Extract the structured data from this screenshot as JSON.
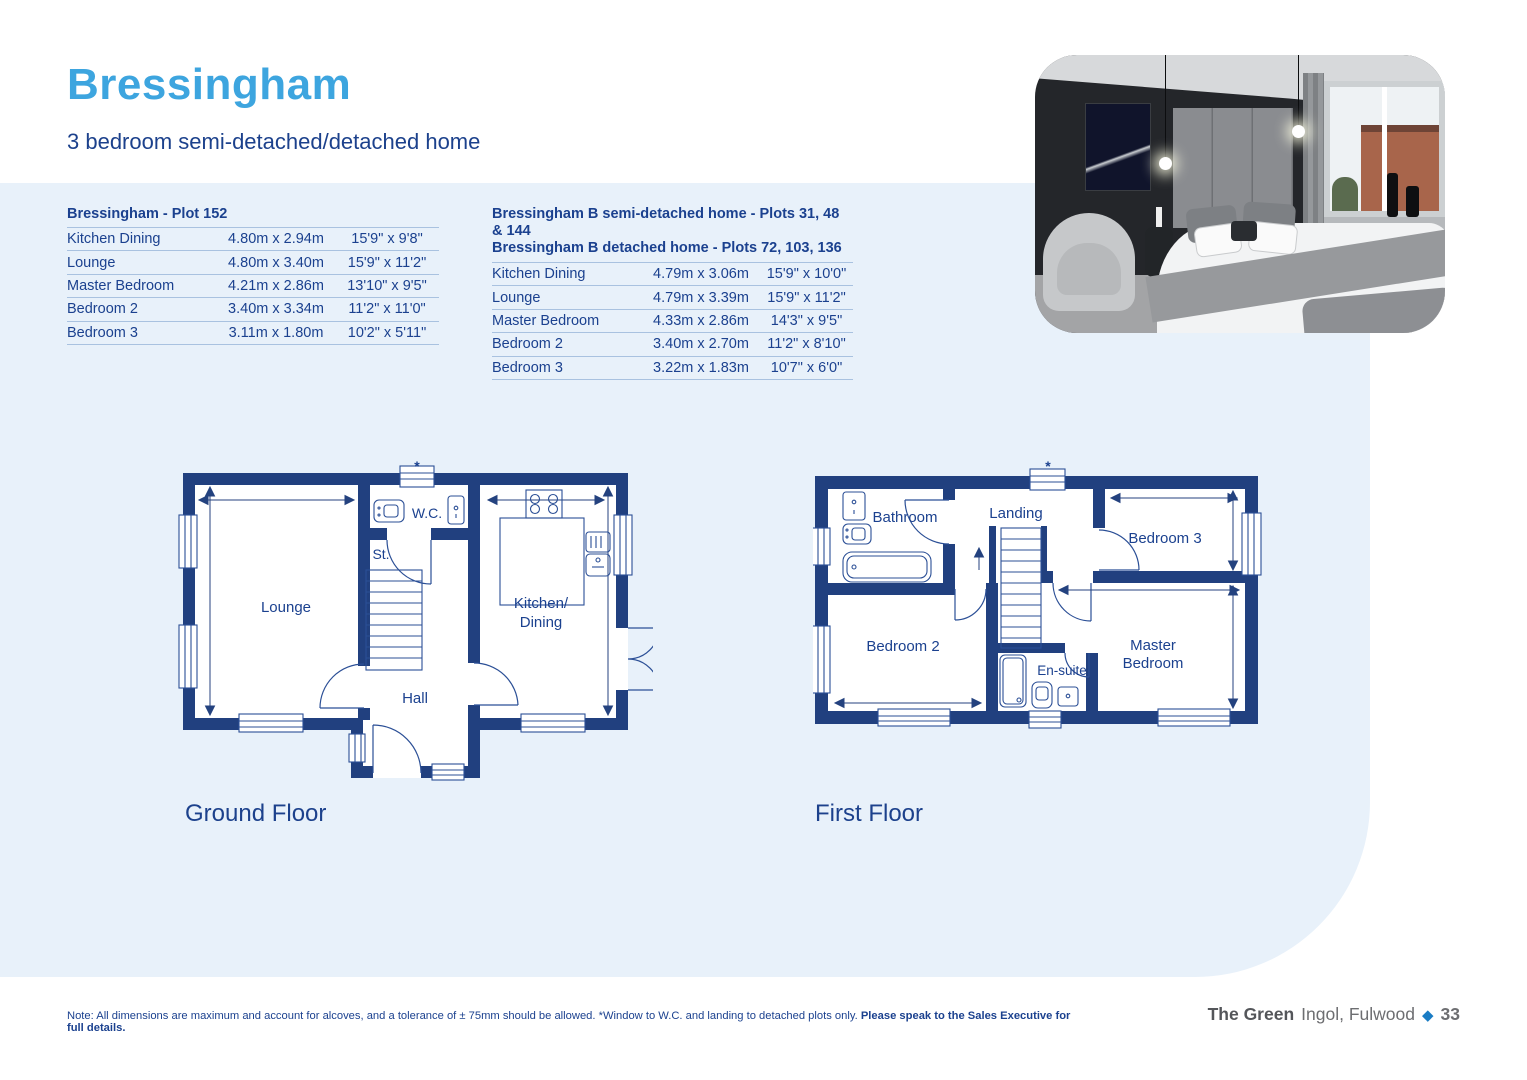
{
  "page": {
    "title": "Bressingham",
    "subtitle": "3 bedroom semi-detached/detached home"
  },
  "tables": {
    "plot152": {
      "title": "Bressingham - Plot 152",
      "rows": [
        {
          "room": "Kitchen Dining",
          "metric": "4.80m x 2.94m",
          "imperial": "15'9\" x 9'8\""
        },
        {
          "room": "Lounge",
          "metric": "4.80m x 3.40m",
          "imperial": "15'9\" x 11'2\""
        },
        {
          "room": "Master Bedroom",
          "metric": "4.21m x 2.86m",
          "imperial": "13'10\" x 9'5\""
        },
        {
          "room": "Bedroom 2",
          "metric": "3.40m x 3.34m",
          "imperial": "11'2\" x 11'0\""
        },
        {
          "room": "Bedroom 3",
          "metric": "3.11m x 1.80m",
          "imperial": "10'2\" x 5'11\""
        }
      ]
    },
    "plotB": {
      "title_line1": "Bressingham B semi-detached home - Plots 31, 48 & 144",
      "title_line2": "Bressingham B detached home - Plots 72, 103, 136",
      "rows": [
        {
          "room": "Kitchen Dining",
          "metric": "4.79m x 3.06m",
          "imperial": "15'9\" x 10'0\""
        },
        {
          "room": "Lounge",
          "metric": "4.79m x 3.39m",
          "imperial": "15'9\" x 11'2\""
        },
        {
          "room": "Master Bedroom",
          "metric": "4.33m x 2.86m",
          "imperial": "14'3\" x 9'5\""
        },
        {
          "room": "Bedroom 2",
          "metric": "3.40m x 2.70m",
          "imperial": "11'2\" x 8'10\""
        },
        {
          "room": "Bedroom 3",
          "metric": "3.22m x 1.83m",
          "imperial": "10'7\" x 6'0\""
        }
      ]
    }
  },
  "floorplans": {
    "ground": {
      "label": "Ground Floor",
      "marker": "*",
      "rooms": {
        "lounge": "Lounge",
        "stairs": "St.",
        "wc": "W.C.",
        "kitchen_line1": "Kitchen/",
        "kitchen_line2": "Dining",
        "hall": "Hall"
      }
    },
    "first": {
      "label": "First Floor",
      "marker": "*",
      "rooms": {
        "bathroom": "Bathroom",
        "landing": "Landing",
        "bedroom3": "Bedroom 3",
        "bedroom2": "Bedroom 2",
        "ensuite": "En-suite",
        "master_line1": "Master",
        "master_line2": "Bedroom"
      }
    }
  },
  "footer": {
    "note_regular": "Note: All dimensions are maximum and account for alcoves, and a tolerance of ± 75mm should be allowed. *Window to W.C. and landing to detached plots only. ",
    "note_bold": "Please speak to the Sales Executive for full details.",
    "development_bold": "The Green",
    "development_location": "Ingol, Fulwood",
    "diamond_glyph": "◆",
    "page_number": "33"
  }
}
